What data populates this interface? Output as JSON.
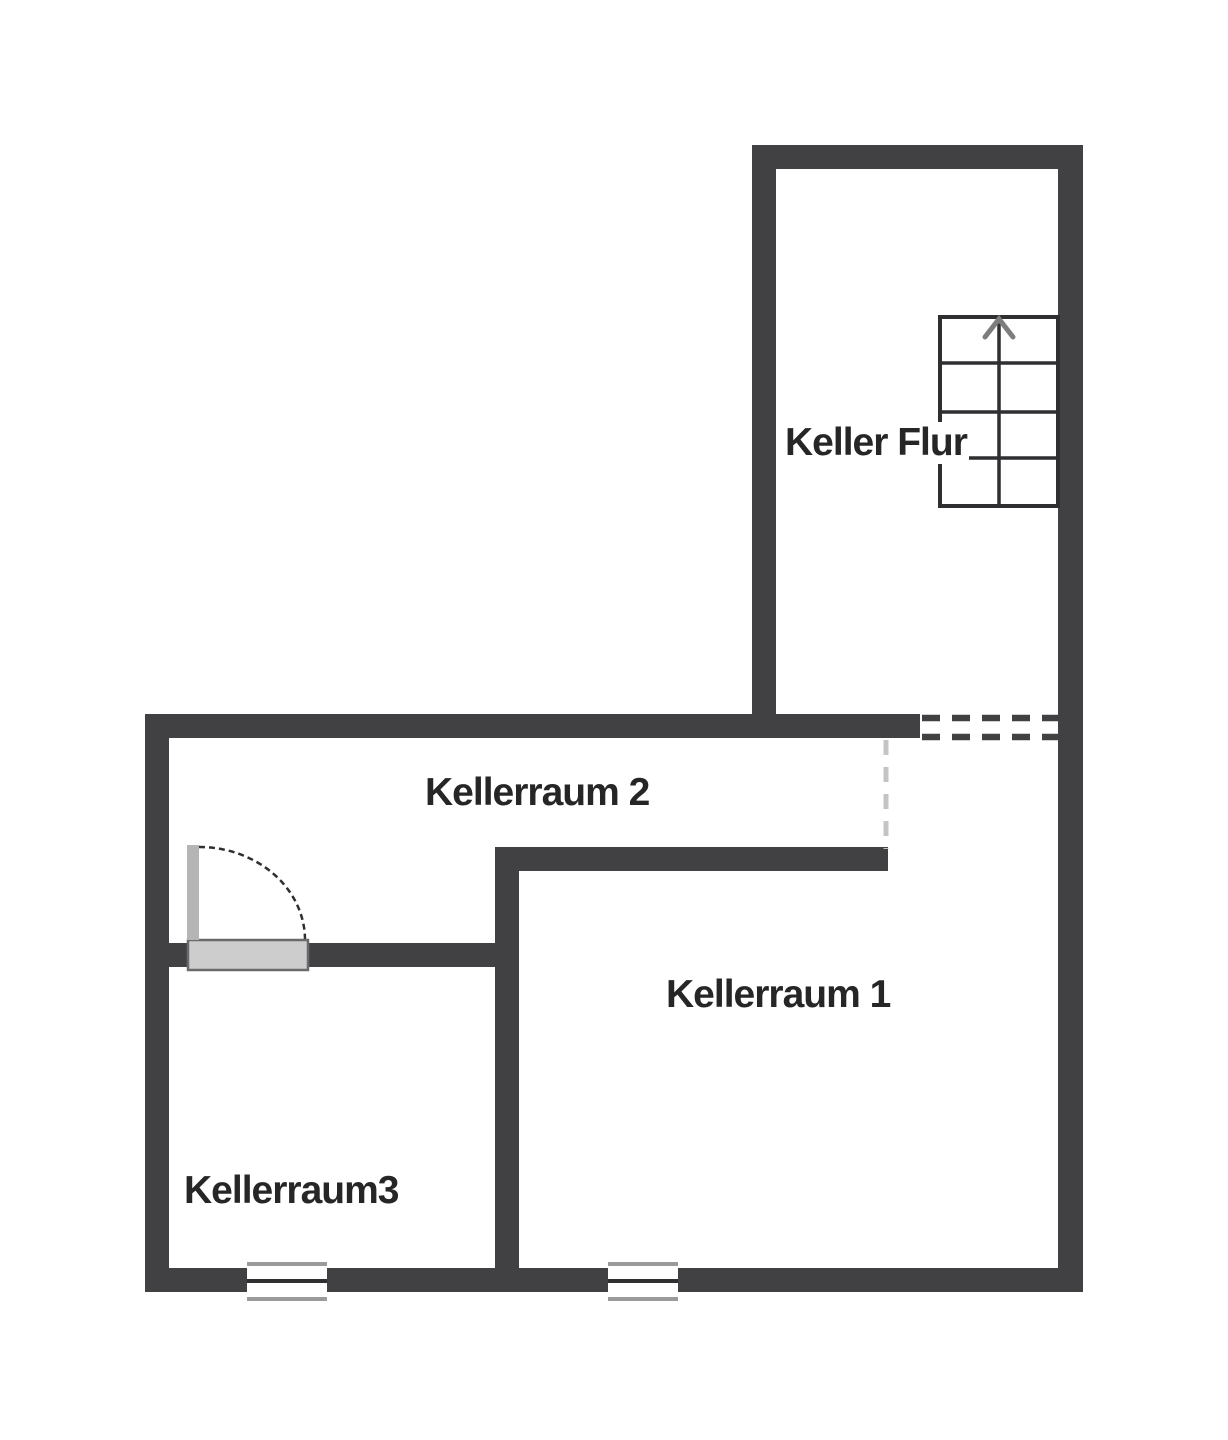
{
  "plan": {
    "type": "floor-plan",
    "floor_name": "Keller",
    "rooms": [
      {
        "id": "keller-flur",
        "label": "Keller Flur"
      },
      {
        "id": "kellerraum-2",
        "label": "Kellerraum 2"
      },
      {
        "id": "kellerraum-1",
        "label": "Kellerraum 1"
      },
      {
        "id": "kellerraum-3",
        "label": "Kellerraum3"
      }
    ],
    "features": {
      "stairs": {
        "location": "keller-flur",
        "treads": 4,
        "direction_arrow": "up"
      },
      "door": {
        "between": [
          "kellerraum-2",
          "kellerraum-3"
        ],
        "swing": "quarter-arc"
      },
      "windows": {
        "count": 2,
        "location": "bottom-outer-wall"
      },
      "open_passage": {
        "between": [
          "keller-flur",
          "kellerraum-1"
        ],
        "style": "dashed"
      },
      "room_boundary_dashed": {
        "between": [
          "kellerraum-2",
          "kellerraum-1"
        ]
      }
    }
  },
  "colors": {
    "bg": "#ffffff",
    "wall": "#414143",
    "line": "#2f2f31",
    "window_line": "#9a9a9a",
    "dash_light": "#c4c4c4",
    "door_leaf": "#b5b5b5",
    "threshold_fill": "#cdcdcd",
    "threshold_border": "#6a6a6a",
    "arrow": "#7d7d7d",
    "text": "#262626"
  }
}
